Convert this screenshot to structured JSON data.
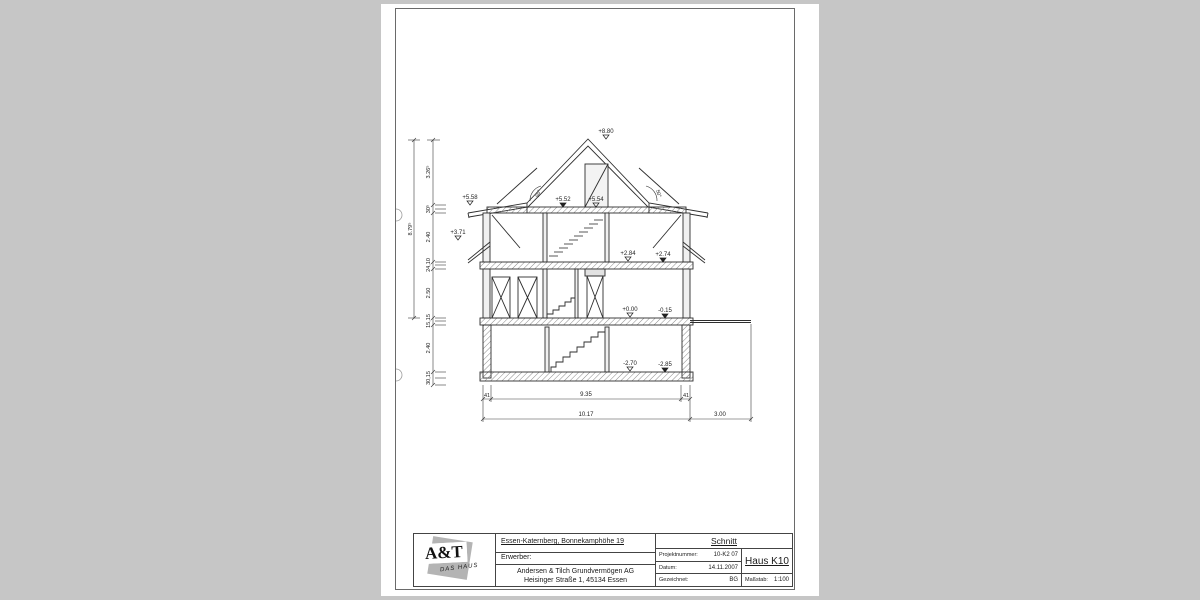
{
  "drawing": {
    "levels": {
      "ridge": "+8.80",
      "eave_left": "+5.58",
      "attic_a": "+5.52",
      "attic_b": "+5.54",
      "skirt_left": "+3.71",
      "og_a": "+2.84",
      "og_b": "+2.74",
      "eg_a": "+0.00",
      "eg_b": "-0.15",
      "kg_a": "-2.70",
      "kg_b": "-2.85"
    },
    "angle_left": "50°",
    "angle_right": "50°",
    "dims_left": [
      "3.26⁵",
      "30⁵",
      "2.40",
      "24,10",
      "2.50",
      "15,15",
      "2.40",
      "30,15"
    ],
    "dim_left_total": "8.79⁵",
    "dims_bottom_row1": [
      "41",
      "9.35",
      "41"
    ],
    "dims_bottom_row2": [
      "10.17",
      "3.00"
    ]
  },
  "title_block": {
    "logo_main": "A&T",
    "logo_sub": "DAS HAUS",
    "site": "Essen-Katernberg, Bonnekamphöhe 19",
    "erwerber_label": "Erwerber:",
    "company_line1": "Andersen & Tilch Grundvermögen AG",
    "company_line2": "Heisinger Straße 1, 45134 Essen",
    "doc_title": "Schnitt",
    "project_label": "Projektnummer:",
    "project_value": "10-K2 07",
    "date_label": "Datum:",
    "date_value": "14.11.2007",
    "drawn_label": "Gezeichnet:",
    "drawn_value": "BG",
    "house": "Haus K10",
    "scale_label": "Maßstab:",
    "scale_value": "1:100"
  }
}
